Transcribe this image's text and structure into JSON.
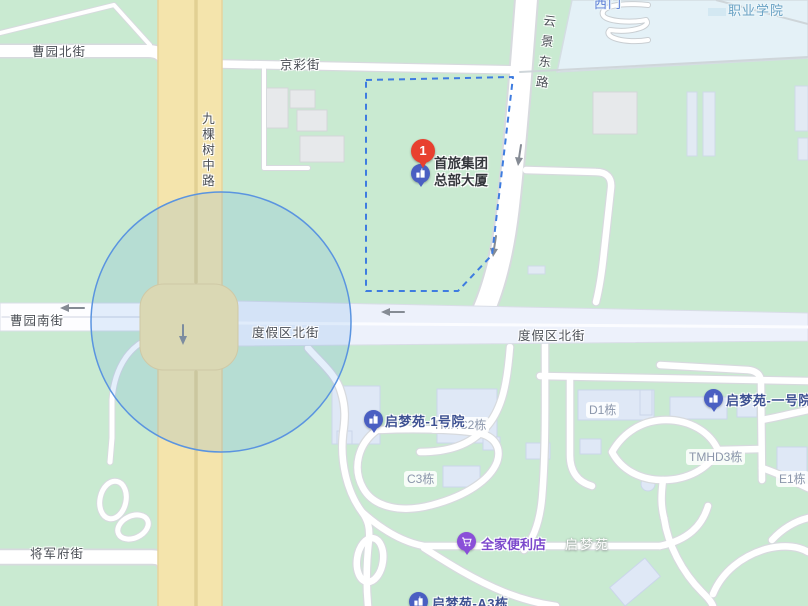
{
  "map": {
    "streets": {
      "caoyuan_north": "曹园北街",
      "jingcai": "京彩街",
      "jiukeshu_middle": "九棵树中路",
      "yunjing_east": "云景东路",
      "caoyuan_south": "曹园南街",
      "dujiaqu_north_w": "度假区北街",
      "dujiaqu_north_e": "度假区北街",
      "jiangjunfu": "将军府街"
    },
    "areas": {
      "vocational_college": "职业学院",
      "west_gate": "西门",
      "qimengyuan": "启梦苑"
    },
    "buildings": {
      "tmhc2": "TMHC2栋",
      "d1": "D1栋",
      "c3": "C3栋",
      "tmhd3": "TMHD3栋",
      "e1": "E1栋"
    },
    "pois": {
      "result_pin_number": "1",
      "shoulv_line1": "首旅集团",
      "shoulv_line2": "总部大厦",
      "qmy_no1_court": "启梦苑-1号院",
      "qmy_no1": "启梦苑-一号院",
      "familymart": "全家便利店",
      "qmy_a3": "启梦苑-A3栋"
    },
    "colors": {
      "selected_pin_red": "#e8402f",
      "poi_marker_blue": "#4a5fc2",
      "store_marker_purple": "#8a4fd8",
      "range_circle_stroke": "#5a94e0",
      "boundary_dash_blue": "#3e7ce0"
    }
  }
}
